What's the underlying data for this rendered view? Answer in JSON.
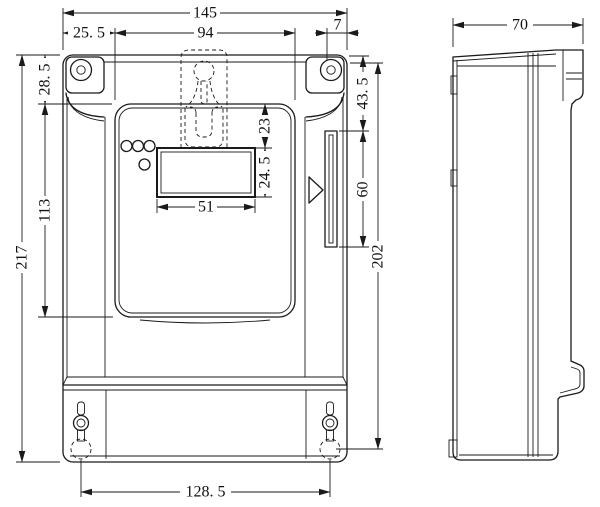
{
  "drawing": {
    "type": "engineering-dimension-drawing",
    "subject": "electric energy meter enclosure, front view and right side view",
    "line_color": "#1a1a1a",
    "background": "#ffffff"
  },
  "dim": {
    "overall_width": "145",
    "left_inset": "25. 5",
    "panel_width": "94",
    "edge_gap": "7",
    "top_inset": "28. 5",
    "panel_height": "113",
    "overall_height": "217",
    "lcd_offset": "23",
    "lcd_height": "24. 5",
    "lcd_width": "51",
    "slot_offset": "43. 5",
    "slot_height": "60",
    "body_height": "202",
    "screw_spacing": "128. 5",
    "depth": "70"
  }
}
